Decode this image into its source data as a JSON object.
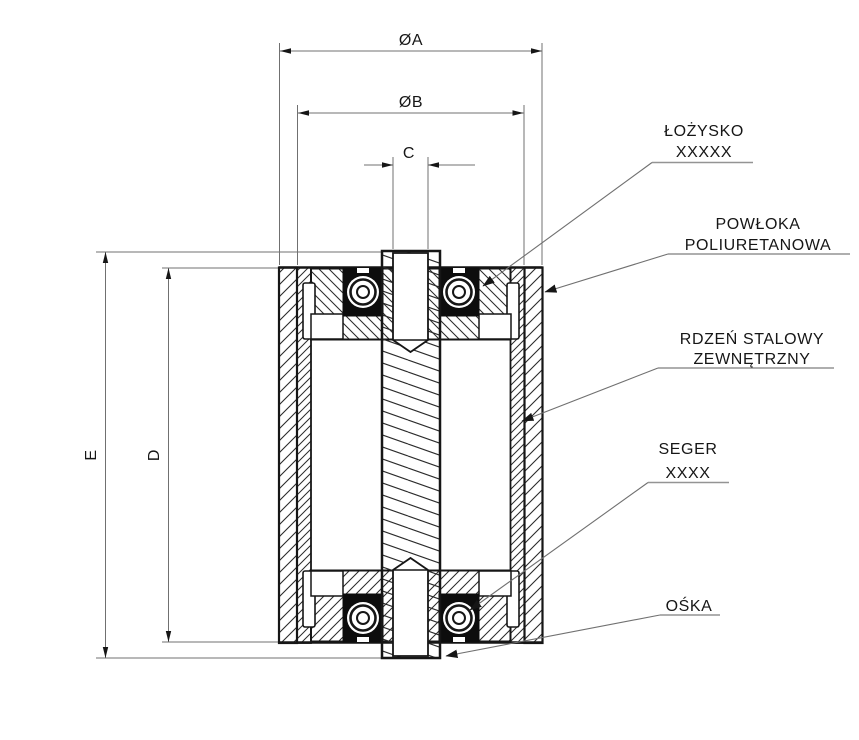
{
  "drawing": {
    "type": "roller-cross-section",
    "dim_labels": {
      "outer_diameter": "ØA",
      "core_diameter": "ØB",
      "bore": "C",
      "roller_height": "D",
      "overall_height": "E"
    },
    "callouts": {
      "bearing": [
        "ŁOŻYSKO",
        "XXXXX"
      ],
      "coating": [
        "POWŁOKA",
        "POLIURETANOWA"
      ],
      "core": [
        "RDZEŃ STALOWY",
        "ZEWNĘTRZNY"
      ],
      "circlip": [
        "SEGER",
        "XXXX"
      ],
      "axle": [
        "OŚKA"
      ]
    },
    "colors": {
      "outline": "#161616",
      "hatch": "#2b2b2b",
      "dimension_lines": "#707070",
      "underline": "#949494",
      "background": "#ffffff"
    }
  }
}
